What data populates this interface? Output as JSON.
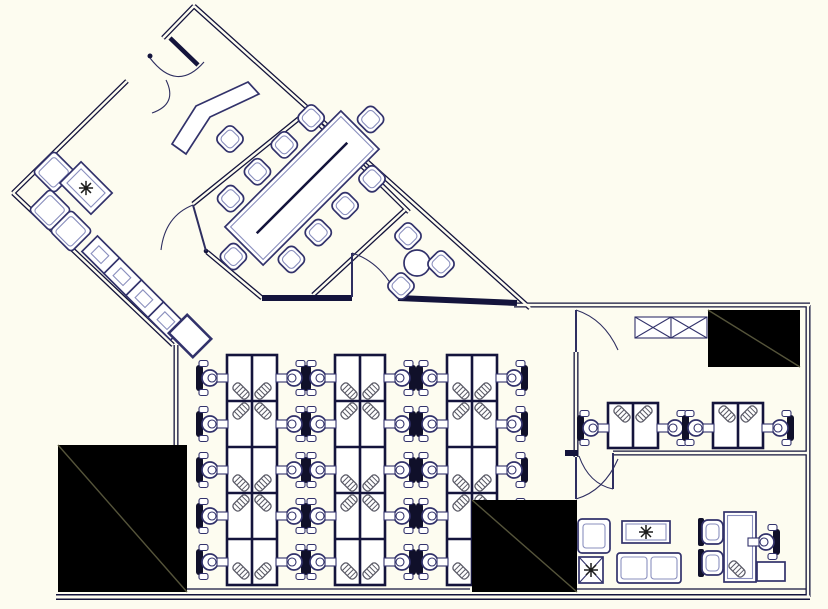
{
  "drawing": {
    "kind": "office floor plan",
    "style": "black-line CAD drawing on off-white background",
    "width_px": 828,
    "height_px": 609
  },
  "colors": {
    "bg": "#fdfcf0",
    "wall": "#14143c",
    "furn": "#32326b",
    "furn_light": "#8a8fbe",
    "chair_dark": "#10102a",
    "core_fill": "#000000",
    "core_diag": "#55543a",
    "hatch": "#5a5a66",
    "plant": "#1c1c1c",
    "door": "#2e2e60"
  },
  "rooms": {
    "reception_lobby": {
      "name": "Entry / reception lobby",
      "furniture": {
        "reception_counter": 1,
        "task_chair": 1
      },
      "door_arcs": 2
    },
    "conference_room": {
      "name": "Conference room",
      "furniture": {
        "boardroom_table": 1,
        "side_chairs": 10
      },
      "door_arcs": 1
    },
    "waiting_corner": {
      "name": "Waiting lounge corner",
      "furniture": {
        "armchair": 1,
        "sofa_seats": 2,
        "coffee_table_with_plant": 1
      }
    },
    "equipment_row": {
      "name": "Cabinet / copier row",
      "furniture": {
        "cabinet_units": 5
      }
    },
    "breakout_nook": {
      "name": "Breakout nook",
      "furniture": {
        "round_table": 1,
        "chairs": 3
      },
      "door_arcs": 1
    },
    "open_office": {
      "name": "Open office",
      "desk_banks": 3,
      "rows_per_bank": 5,
      "workstations": 30,
      "task_chairs": 30,
      "planter_screen_clusters": 6,
      "planter_screen_half_clusters": 3
    },
    "team_room": {
      "name": "Team room",
      "desk_clusters": 2,
      "workstations": 4,
      "task_chairs": 4,
      "storage_lockers_x": 2,
      "door_arcs": 2
    },
    "executive_office": {
      "name": "Executive office / lounge",
      "furniture": {
        "desk": 1,
        "task_chair": 1,
        "guest_chairs": 2,
        "sofa_2seat": 1,
        "armchair": 1,
        "coffee_table_with_plant": 1,
        "floor_plant_pot": 1,
        "credenza": 1,
        "keyboard_tray": 1
      },
      "door_arcs": 1
    },
    "service_cores": {
      "name": "Solid service cores",
      "count": 3,
      "locations": [
        "south_west",
        "south_center",
        "north_east"
      ]
    }
  },
  "totals": {
    "door_arcs": 7,
    "chairs_all": 51,
    "plants": 3
  },
  "symbols": {
    "plant_icon": "asterisk star",
    "storage_locker_icon": "rectangle with X",
    "planter_screen_icon": "diagonal striped bar",
    "task_chair_icon": "circle seat with solid back",
    "core_icon": "solid black block with diagonal"
  }
}
